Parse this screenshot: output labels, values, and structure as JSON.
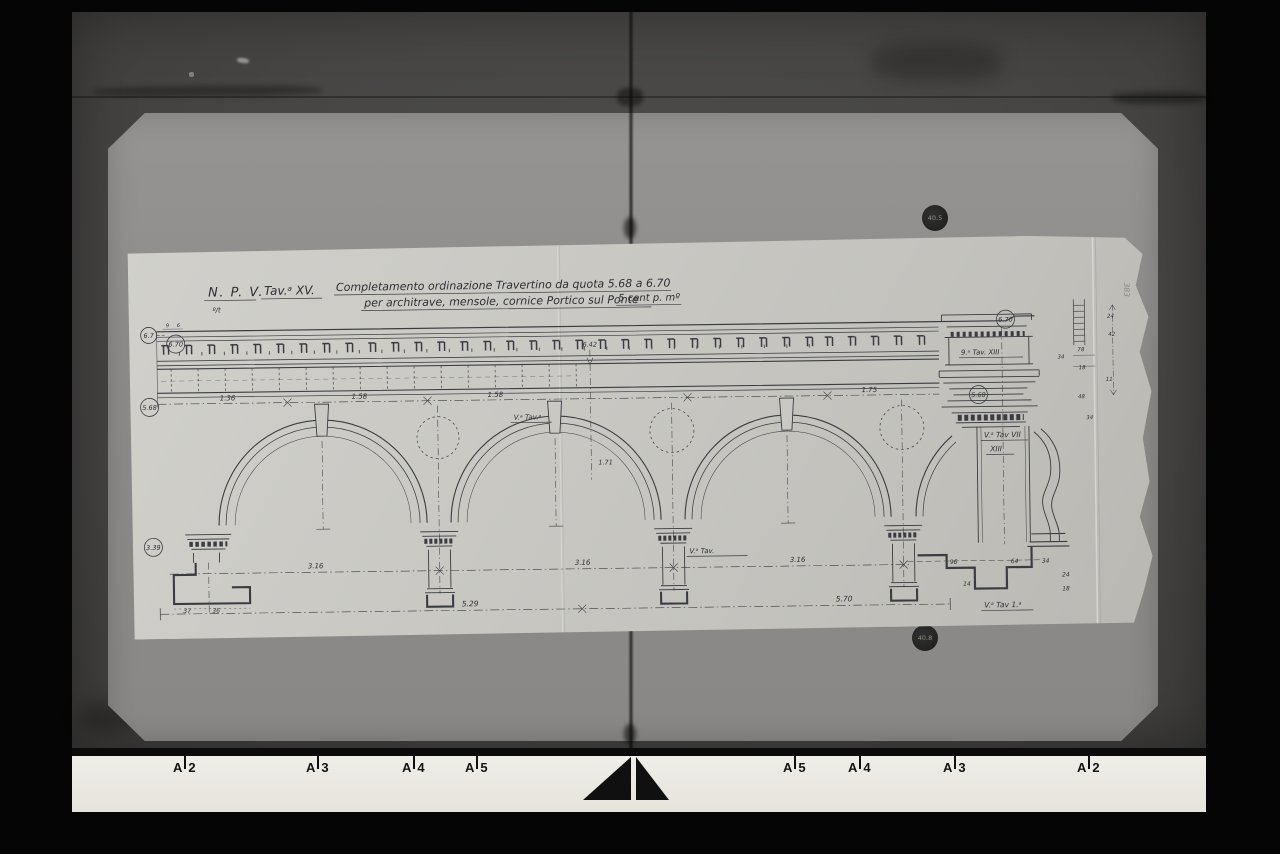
{
  "palette": {
    "ink": "#3b3c42",
    "sheet": "#cac9c4",
    "board": "#8d8c8a",
    "background": "#474645"
  },
  "drawing": {
    "title": {
      "npv": "N. P. V.",
      "tav": "Tav.ᵃ XV.",
      "line1": "Completamento ordinazione Travertino da quota 5.68 a 6.70",
      "line2": "per architrave, mensole, cornice Portico sul Ponte",
      "scale": "5 cent p. mº",
      "mark": "º/t"
    },
    "levels": {
      "left_top_a": "6.7",
      "left_top_b": "6.70",
      "left_mid": "5.68",
      "left_low": "3.39",
      "right_top": "6.70",
      "right_mid": "5.68"
    },
    "arch_dims": [
      "1.36",
      "1.58",
      "1.58",
      "1.75"
    ],
    "span_dims": [
      "3.16",
      "3.16",
      "3.16"
    ],
    "bottom_dims": {
      "left": "5.29",
      "right": "5.70"
    },
    "quotas": {
      "upper": "6.42",
      "lower": "1.71"
    },
    "micro_dims": [
      "9",
      "6"
    ],
    "plan_dims_left": [
      "37",
      "36"
    ],
    "plan_dims_right": [
      "14",
      "96",
      "64",
      "34",
      "24",
      "18"
    ],
    "profile_dims": [
      "24",
      "42",
      "78",
      "34",
      "18",
      "11",
      "48",
      "34"
    ],
    "tav_labels": {
      "keystone": "V.ᵃ Tav.ᵃ",
      "pier_mid": "V.ᵃ Tav.",
      "frieze": "9.ᵃ Tav. XIII",
      "pier_right_line1": "V.ᵃ Tav VII",
      "pier_right_line2": "XIII",
      "plan_right": "V.ᵃ Tav 1.ᵃ"
    },
    "edge_stamp": "383"
  },
  "board": {
    "stamps": {
      "top": "40.5",
      "bottom": "40.8"
    }
  },
  "ruler": {
    "marks": [
      {
        "letter": "A",
        "number": "2"
      },
      {
        "letter": "A",
        "number": "3"
      },
      {
        "letter": "A",
        "number": "4"
      },
      {
        "letter": "A",
        "number": "5"
      },
      {
        "letter": "A",
        "number": "5"
      },
      {
        "letter": "A",
        "number": "4"
      },
      {
        "letter": "A",
        "number": "3"
      },
      {
        "letter": "A",
        "number": "2"
      }
    ]
  }
}
